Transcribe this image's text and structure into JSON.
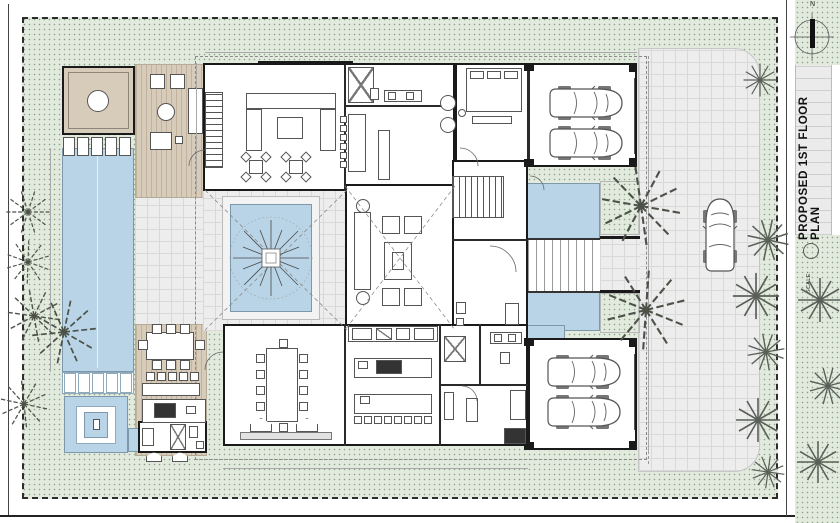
{
  "titleblock": {
    "title": "PROPOSED 1ST FLOOR PLAN",
    "scale_label": "SCALE:",
    "north_label": "N"
  },
  "colors": {
    "wall": "#1a1a1a",
    "furn": "#555555",
    "lawn": "#e2eadd",
    "lawnDot": "#8aa389",
    "water": "#b9d4e6",
    "waterEdge": "#7d98ab",
    "deck": "#d7ccb9",
    "deckLine": "#c2b29b",
    "paver": "#ededed",
    "paverLine": "#d9d9d9",
    "dim": "#a9a9a9",
    "tree": "#4c5248"
  },
  "plan_inventory": {
    "cars_in_top_garage": 2,
    "cars_in_bottom_garage": 2,
    "cars_on_driveway": 1,
    "palm_trees_left_edge": 5,
    "palm_trees_entry_beds": 2,
    "agave_plants": 9,
    "pool_loungers": 5,
    "cabana_daybeds": 5,
    "courtyard_trees": 1
  }
}
